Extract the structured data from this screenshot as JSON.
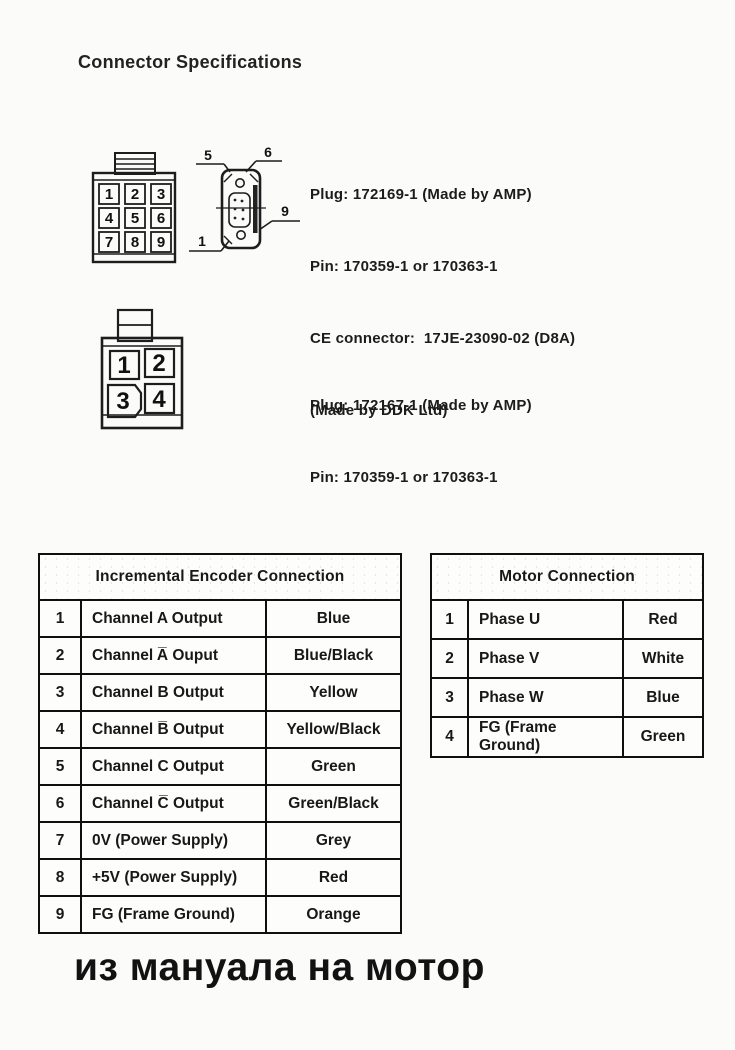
{
  "page": {
    "title": "Connector Specifications",
    "footer_note": "из мануала на мотор"
  },
  "connector_encoder": {
    "front_pins": [
      "1",
      "2",
      "3",
      "4",
      "5",
      "6",
      "7",
      "8",
      "9"
    ],
    "side_callouts": {
      "top_left": "5",
      "top_right": "6",
      "right": "9",
      "bottom_left": "1"
    },
    "specs": [
      "Plug: 172169-1 (Made by AMP)",
      "Pin: 170359-1 or 170363-1",
      "CE connector:  17JE-23090-02 (D8A)",
      "(Made by DDK Ltd)"
    ]
  },
  "connector_motor": {
    "front_pins": [
      "1",
      "2",
      "3",
      "4"
    ],
    "specs": [
      "Plug: 172167-1 (Made by AMP)",
      "Pin: 170359-1 or 170363-1"
    ]
  },
  "encoder_table": {
    "title": "Incremental Encoder Connection",
    "rows": [
      {
        "pin": "1",
        "signal": "Channel A Output",
        "color": "Blue"
      },
      {
        "pin": "2",
        "signal": "Channel A̅ Ouput",
        "color": "Blue/Black"
      },
      {
        "pin": "3",
        "signal": "Channel B Output",
        "color": "Yellow"
      },
      {
        "pin": "4",
        "signal": "Channel B̅ Output",
        "color": "Yellow/Black"
      },
      {
        "pin": "5",
        "signal": "Channel C Output",
        "color": "Green"
      },
      {
        "pin": "6",
        "signal": "Channel C̅ Output",
        "color": "Green/Black"
      },
      {
        "pin": "7",
        "signal": "0V (Power Supply)",
        "color": "Grey"
      },
      {
        "pin": "8",
        "signal": "+5V (Power Supply)",
        "color": "Red"
      },
      {
        "pin": "9",
        "signal": "FG (Frame Ground)",
        "color": "Orange"
      }
    ]
  },
  "motor_table": {
    "title": "Motor Connection",
    "rows": [
      {
        "pin": "1",
        "signal": "Phase U",
        "color": "Red"
      },
      {
        "pin": "2",
        "signal": "Phase V",
        "color": "White"
      },
      {
        "pin": "3",
        "signal": "Phase W",
        "color": "Blue"
      },
      {
        "pin": "4",
        "signal": "FG (Frame Ground)",
        "color": "Green"
      }
    ]
  },
  "ink_color": "#161616",
  "paper_color": "#fbfbfa"
}
